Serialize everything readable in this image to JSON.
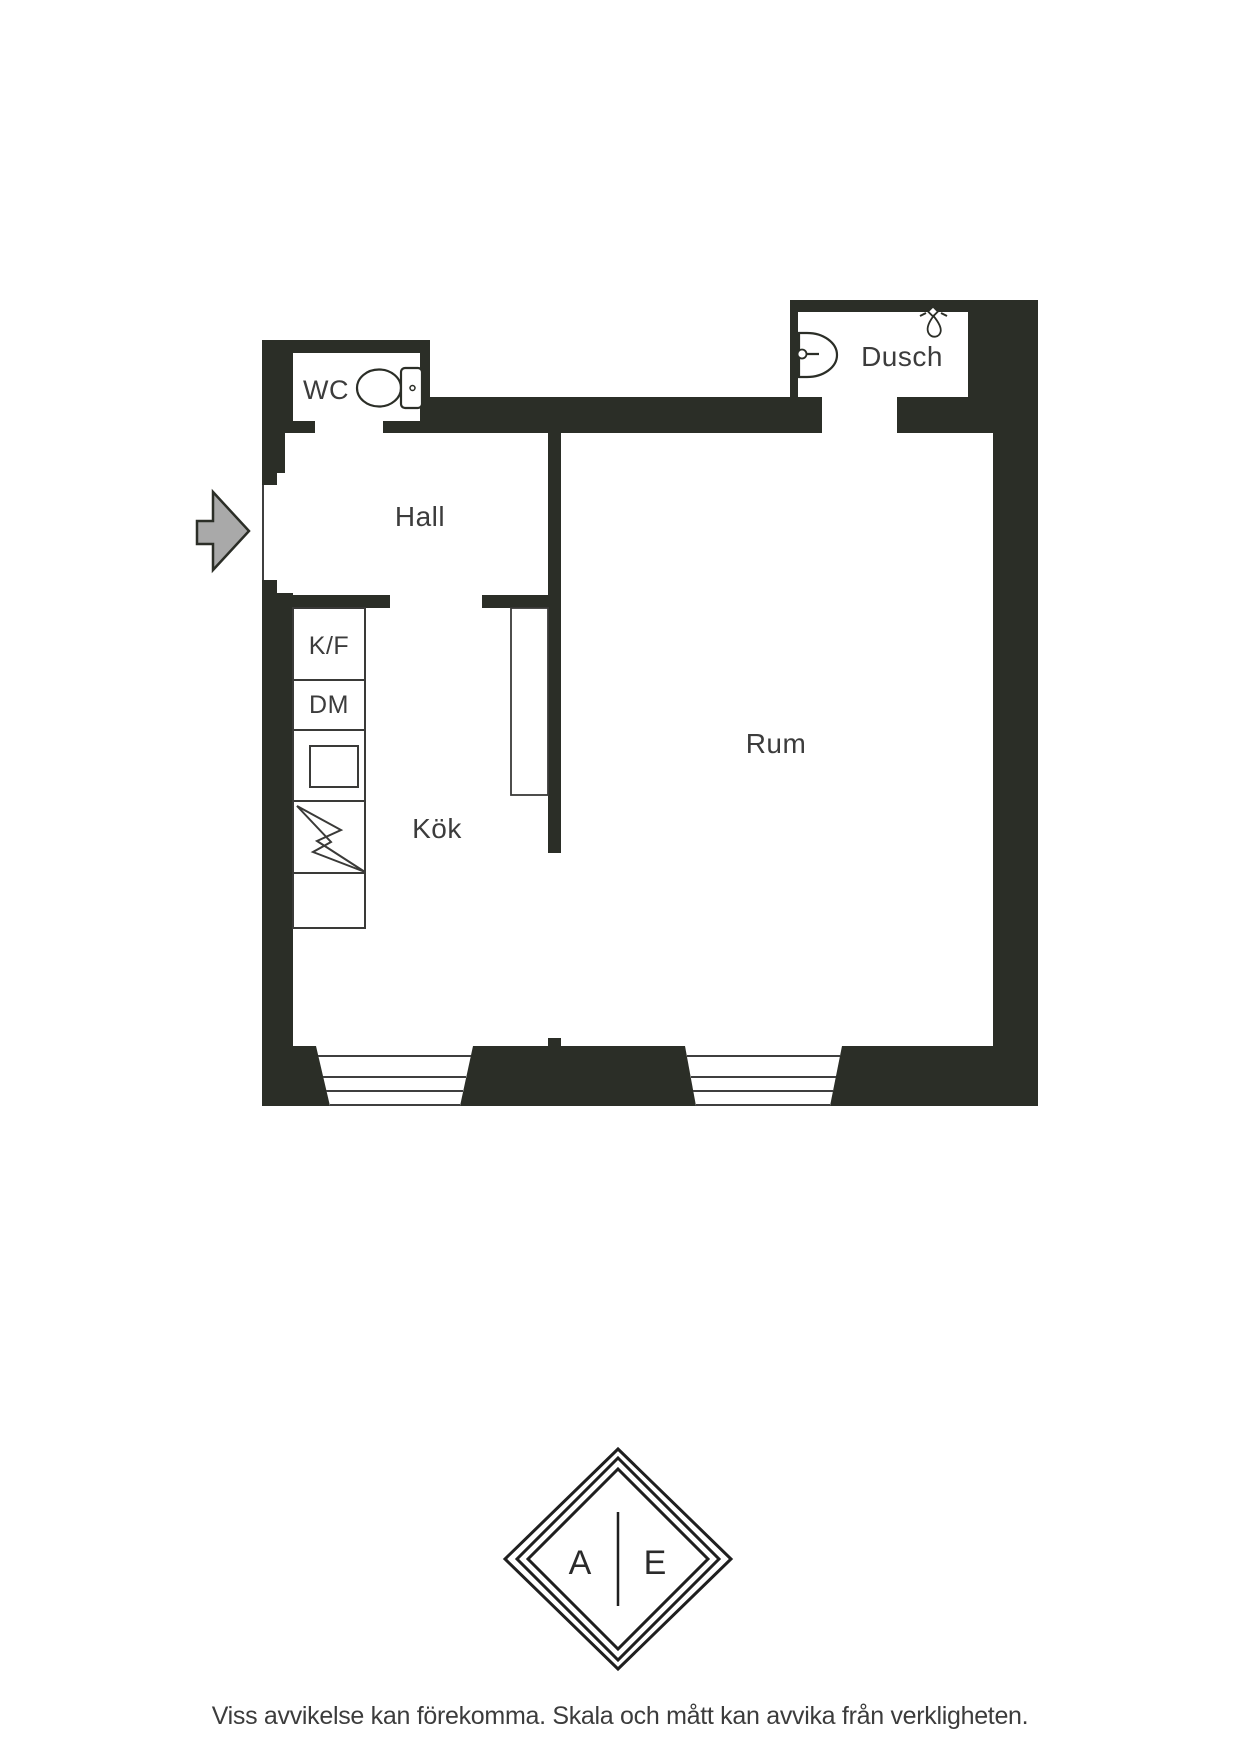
{
  "floor_plan": {
    "rooms": {
      "wc": "WC",
      "hall": "Hall",
      "dusch": "Dusch",
      "kok": "Kök",
      "rum": "Rum"
    },
    "kitchen_units": {
      "fridge_freezer": "K/F",
      "dishwasher": "DM"
    },
    "icons": {
      "entrance_arrow": "entrance-arrow-icon",
      "toilet": "toilet-icon",
      "sink": "sink-icon",
      "shower": "shower-head-icon",
      "stove_lightning": "stove-lightning-icon"
    }
  },
  "logo": {
    "left_letter": "A",
    "right_letter": "E"
  },
  "footer": {
    "disclaimer": "Viss avvikelse kan förekomma. Skala och mått kan avvika från verkligheten."
  },
  "colors": {
    "background": "#ffffff",
    "wall": "#2b2e27",
    "line": "#3f3f3f",
    "label_text": "#3c3c3c",
    "arrow_fill": "#a9a9a9",
    "logo_ink": "#1f1f1f"
  }
}
